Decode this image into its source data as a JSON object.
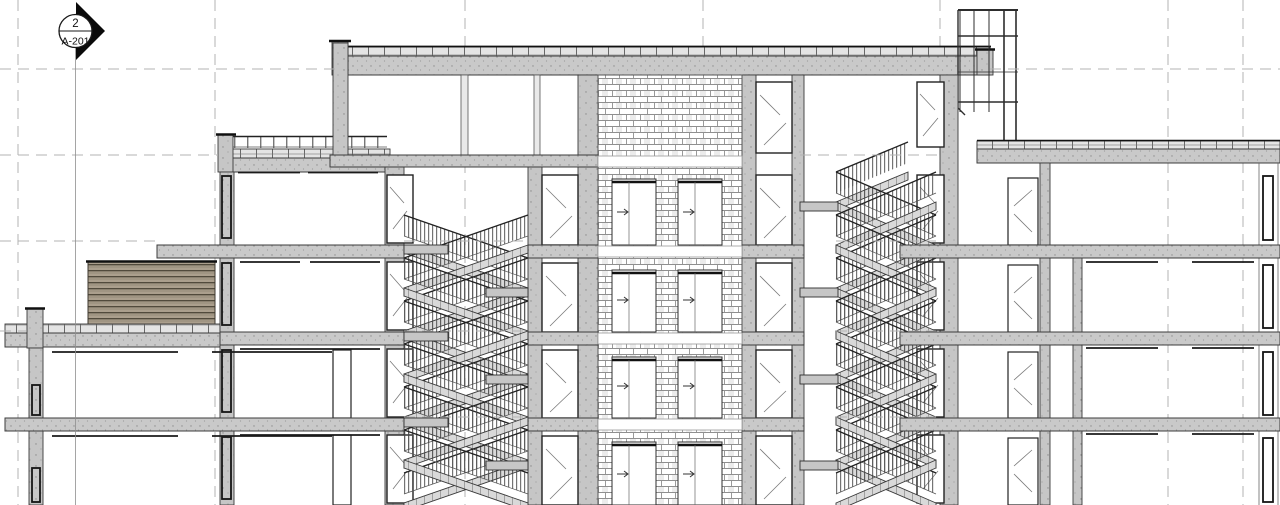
{
  "page": {
    "type": "architectural building section drawing",
    "background": "#ffffff"
  },
  "section_marker": {
    "detail_number": "2",
    "sheet_ref": "A-201",
    "icon": "section-head-diamond"
  },
  "grid": {
    "vertical_lines_x": [
      18,
      215,
      465,
      703,
      940,
      1168,
      1243
    ],
    "level_lines_y": [
      69,
      155,
      241,
      331,
      417
    ],
    "line_style": "dashed"
  },
  "drawing": {
    "stair_towers": 2,
    "stair_type": "scissor stairs with picket railings",
    "elevator_shaft": {
      "wall_pattern": "brick",
      "doors_per_floor": 2,
      "door_arrow": "right"
    },
    "levels_visible": 5,
    "features": [
      "left low wing with rooftop louver screen",
      "left wing with roof guardrail",
      "right wing",
      "rooftop glazed frame structure",
      "glazed doors at stair towers"
    ]
  },
  "colors": {
    "line": "#3a3a3a",
    "slab_fill": "#c9c9c9",
    "wall_fill": "#c6c6c6",
    "grid_line": "#b3b3b3",
    "louver_fill": "#ab9f8d",
    "marker_black": "#0a0a0a",
    "background": "#ffffff"
  },
  "icons": {
    "section_head": "filled diamond arrow with circle",
    "elevator_door_arrow": "right-arrow"
  }
}
